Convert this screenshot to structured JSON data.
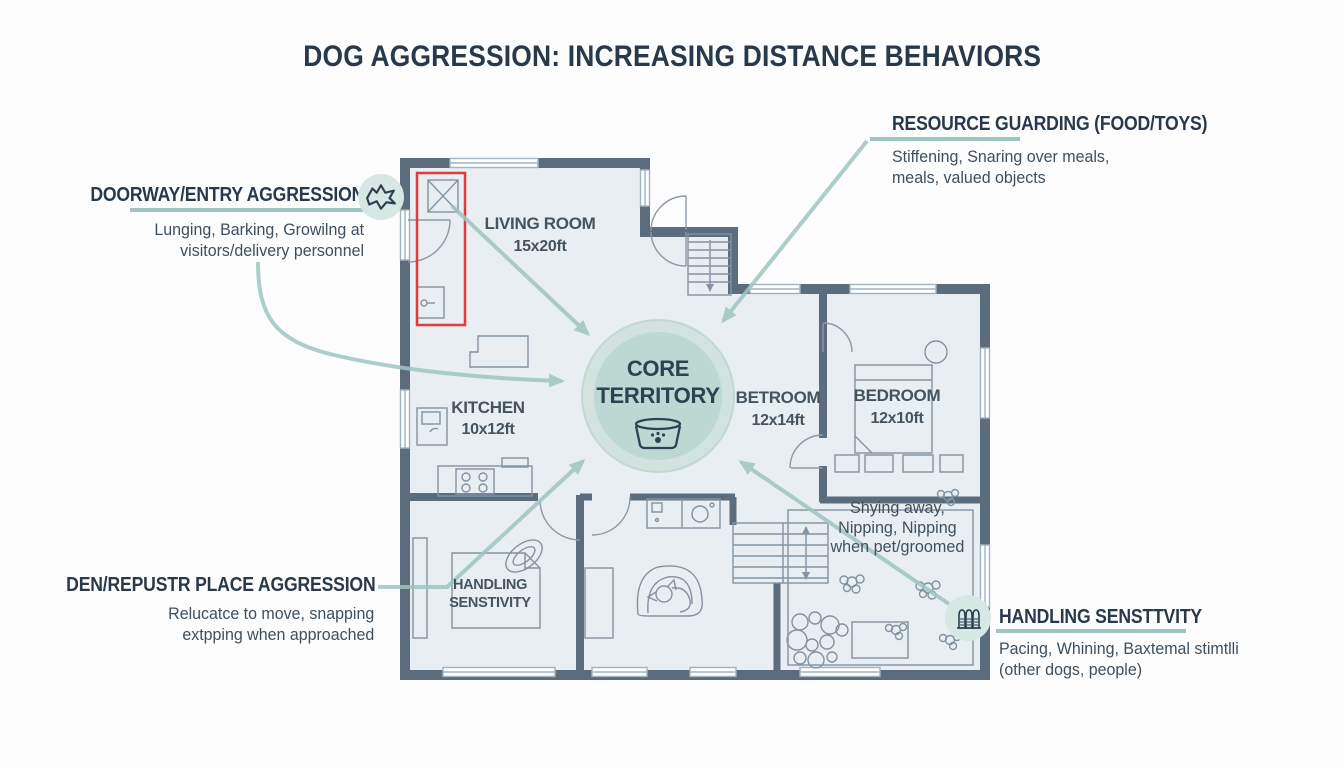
{
  "title": "DOG AGGRESSION: INCREASING DISTANCE BEHAVIORS",
  "annotations": {
    "doorway": {
      "heading": "DOORWAY/ENTRY AGGRESSION",
      "line1": "Lunging, Barking, Growilng at",
      "line2": "visitors/delivery personnel"
    },
    "resource": {
      "heading": "RESOURCE GUARDING (FOOD/TOYS)",
      "line1": "Stiffening, Snaring over meals,",
      "line2": "meals, valued objects"
    },
    "den": {
      "heading": "DEN/REPUSTR PLACE AGGRESSION",
      "line1": "Relucatce to move, snapping",
      "line2": "extpping when approached"
    },
    "handling": {
      "heading": "HANDLING SENSTTVITY",
      "line1": "Pacing, Whining, Baxtemal stimtlli",
      "line2": "(other dogs, people)"
    }
  },
  "floorplan": {
    "core": {
      "line1": "CORE",
      "line2": "TERRITORY"
    },
    "rooms": {
      "living": {
        "name": "LIVING ROOM",
        "size": "15x20ft"
      },
      "kitchen": {
        "name": "KITCHEN",
        "size": "10x12ft"
      },
      "betroom": {
        "name": "BETROOM",
        "size": "12x14ft"
      },
      "bedroom": {
        "name": "BEDROOM",
        "size": "12x10ft"
      },
      "handling_room": {
        "line1": "HANDLING",
        "line2": "SENSTIVITY"
      }
    },
    "notes": {
      "shying": {
        "line1": "Shying away,",
        "line2": "Nipping, Nipping",
        "line3": "when pet/groomed"
      }
    }
  },
  "icons": {
    "doorway_icon": "dog-head-icon",
    "handling_icon": "grooming-brushes-icon",
    "core_icon": "dog-bowl-icon"
  },
  "colors": {
    "accent_teal": "#9ec6c1",
    "core_outer": "#d2e3df",
    "core_inner": "#bcd8d2",
    "wall": "#5b6c7d",
    "floor": "#e9eef3",
    "thin_line": "#8293a2",
    "alert_red": "#e23b3b",
    "heading_text": "#29394b"
  }
}
